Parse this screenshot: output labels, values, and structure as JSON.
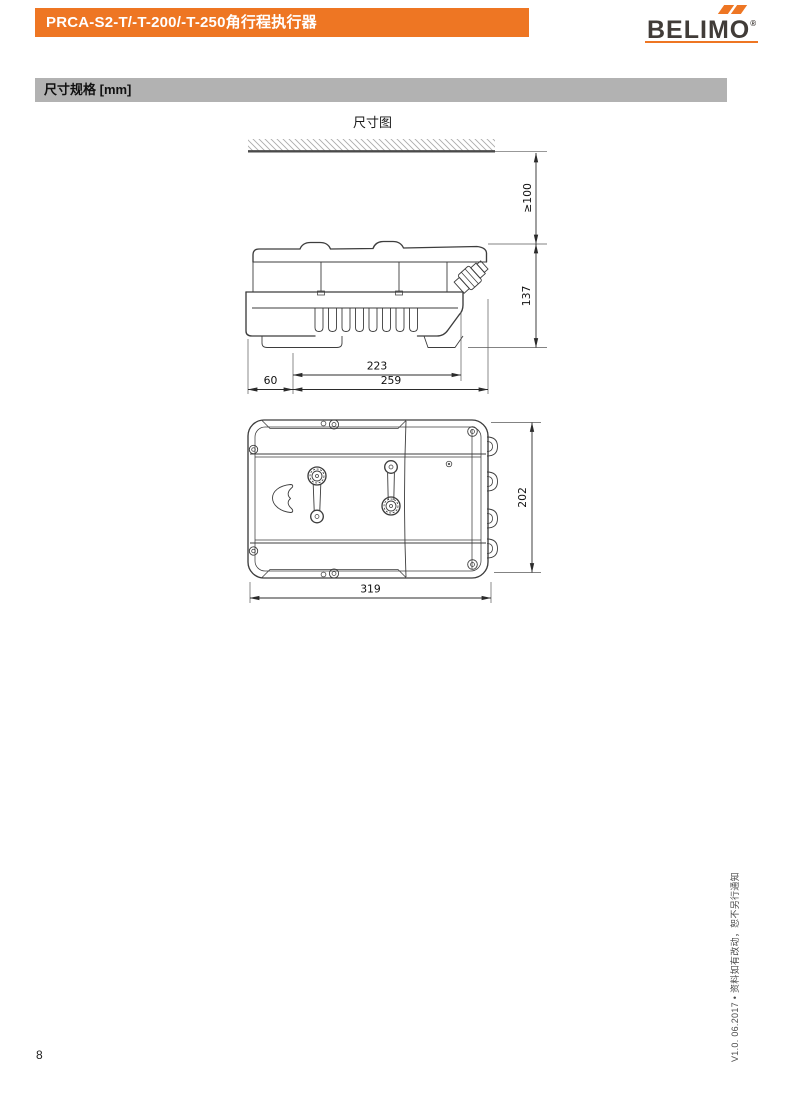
{
  "header": {
    "title": "PRCA-S2-T/-T-200/-T-250角行程执行器",
    "brand": "BELIMO",
    "brand_reg": "®",
    "accent_color": "#EE7623",
    "brand_text_color": "#413C38"
  },
  "section_bar": {
    "label": "尺寸规格 [mm]",
    "bg_color": "#B2B2B2"
  },
  "figure": {
    "title": "尺寸图",
    "units": "mm",
    "dimensions": {
      "clearance": "≥100",
      "height": "137",
      "body_width": "223",
      "offset": "60",
      "total_width": "259",
      "depth": "202",
      "length": "319"
    }
  },
  "footer": {
    "page_number": "8",
    "side_note": "V1.0. 06.2017 • 资料如有改动，恕不另行通知"
  }
}
